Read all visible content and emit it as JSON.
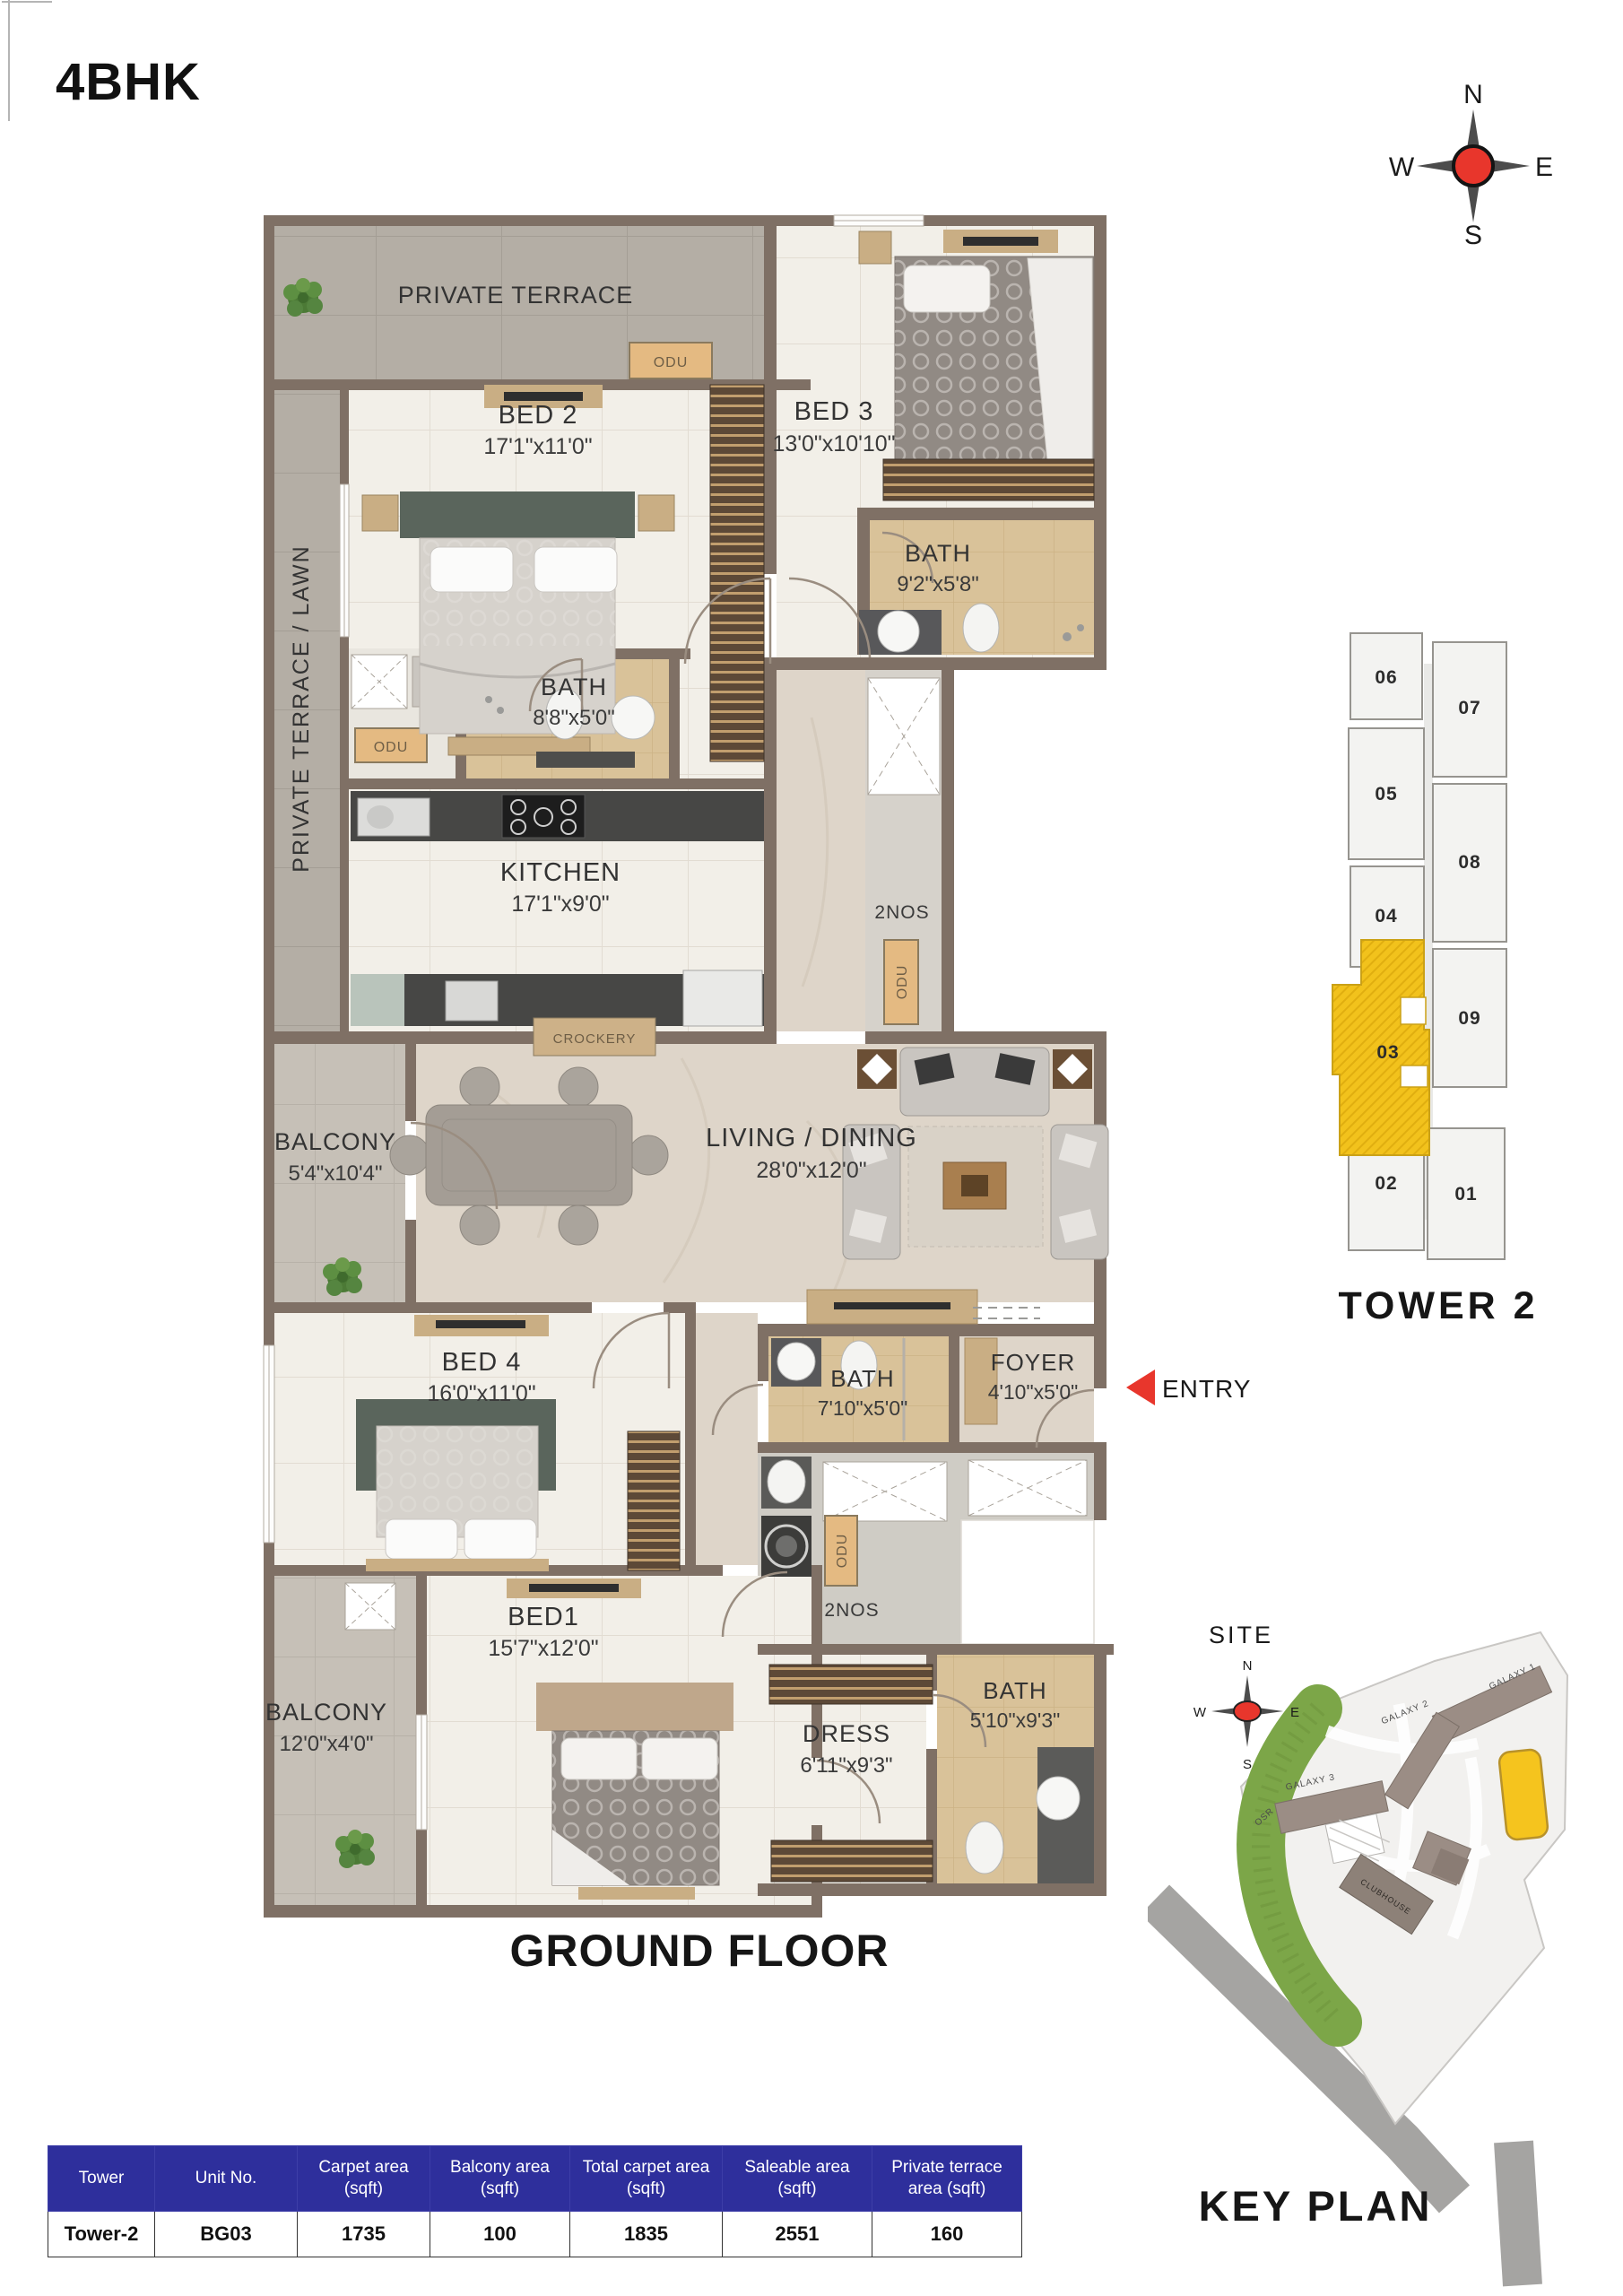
{
  "page": {
    "title": "4BHK",
    "floor_title": "GROUND FLOOR"
  },
  "compass": {
    "n": "N",
    "e": "E",
    "s": "S",
    "w": "W"
  },
  "colors": {
    "accent_yellow": "#f2c21c",
    "entry_red": "#e8362c",
    "compass_red": "#e8362c",
    "table_header_blue": "#2e2f9c",
    "wall_brown": "#7f7065"
  },
  "floor_plan": {
    "labels": {
      "private_terrace": "PRIVATE TERRACE",
      "private_terrace_lawn": "PRIVATE TERRACE / LAWN",
      "odu": "ODU",
      "two_nos": "2NOS",
      "crockery": "CROCKERY",
      "entry": "ENTRY"
    },
    "rooms": {
      "bed2": {
        "name": "BED 2",
        "size": "17'1\"x11'0\""
      },
      "bed3": {
        "name": "BED 3",
        "size": "13'0\"x10'10\""
      },
      "bath_bed3": {
        "name": "BATH",
        "size": "9'2\"x5'8\""
      },
      "bath_bed2": {
        "name": "BATH",
        "size": "8'8\"x5'0\""
      },
      "kitchen": {
        "name": "KITCHEN",
        "size": "17'1\"x9'0\""
      },
      "balcony_living": {
        "name": "BALCONY",
        "size": "5'4\"x10'4\""
      },
      "living": {
        "name": "LIVING / DINING",
        "size": "28'0\"x12'0\""
      },
      "bed4": {
        "name": "BED 4",
        "size": "16'0\"x11'0\""
      },
      "bath_common": {
        "name": "BATH",
        "size": "7'10\"x5'0\""
      },
      "foyer": {
        "name": "FOYER",
        "size": "4'10\"x5'0\""
      },
      "bed1": {
        "name": "BED1",
        "size": "15'7\"x12'0\""
      },
      "balcony_bed1": {
        "name": "BALCONY",
        "size": "12'0\"x4'0\""
      },
      "dress": {
        "name": "DRESS",
        "size": "6'11\"x9'3\""
      },
      "bath_bed1": {
        "name": "BATH",
        "size": "5'10\"x9'3\""
      }
    }
  },
  "tower": {
    "title": "TOWER 2",
    "highlighted_unit": "03",
    "left_units": [
      "06",
      "05",
      "04",
      "03",
      "02"
    ],
    "right_units": [
      "07",
      "08",
      "09",
      "01"
    ]
  },
  "key_plan": {
    "title": "KEY PLAN",
    "site_label": "SITE",
    "buildings": {
      "galaxy1": "GALAXY 1",
      "galaxy2": "GALAXY 2",
      "galaxy3": "GALAXY 3",
      "clubhouse": "CLUBHOUSE",
      "osr": "OSR"
    }
  },
  "area_table": {
    "columns": [
      "Tower",
      "Unit No.",
      "Carpet area (sqft)",
      "Balcony area (sqft)",
      "Total carpet area (sqft)",
      "Saleable area (sqft)",
      "Private terrace area (sqft)"
    ],
    "rows": [
      [
        "Tower-2",
        "BG03",
        "1735",
        "100",
        "1835",
        "2551",
        "160"
      ]
    ]
  }
}
